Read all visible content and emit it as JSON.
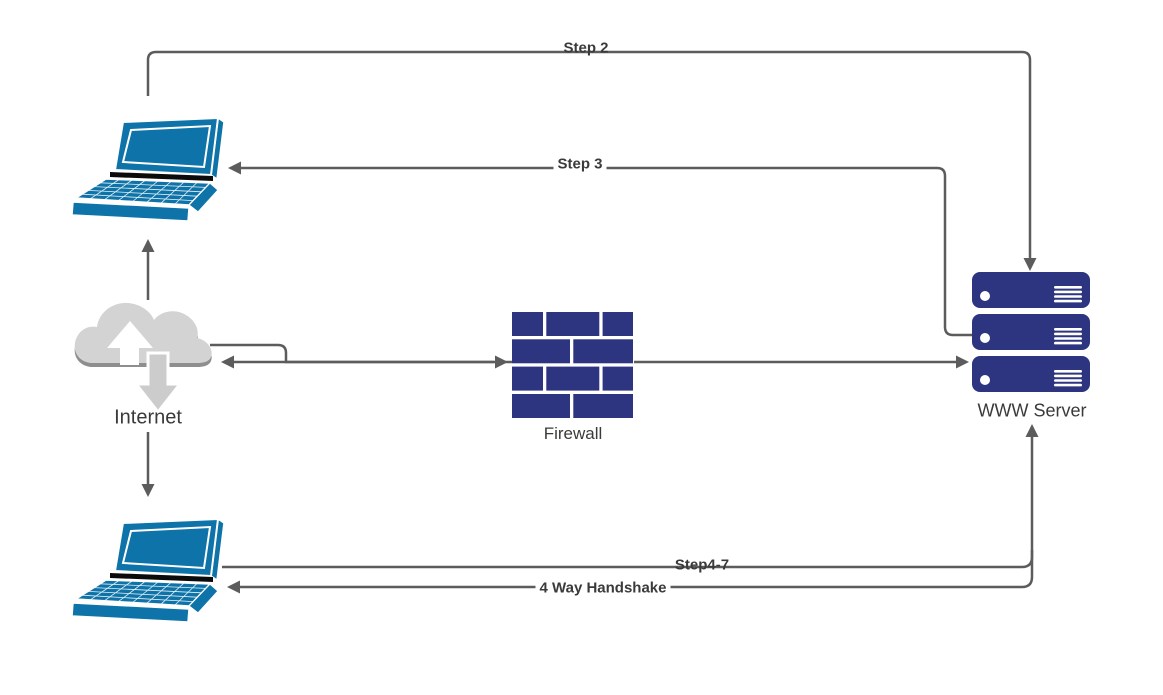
{
  "canvas": {
    "width": 1163,
    "height": 695,
    "background": "#ffffff"
  },
  "colors": {
    "device_blue": "#0d73a8",
    "navy": "#2d3480",
    "cloud_gray": "#d3d3d3",
    "cloud_shadow_gray": "#8e8e8e",
    "connector_gray": "#5c5c5c",
    "label_color": "#3a3a3a"
  },
  "nodes": {
    "internet": {
      "label": "Internet",
      "icon": "cloud-with-arrows"
    },
    "firewall": {
      "label": "Firewall",
      "icon": "brick-wall"
    },
    "server": {
      "label": "WWW Server",
      "icon": "server-stack"
    },
    "client_top": {
      "icon": "laptop"
    },
    "client_bottom": {
      "icon": "laptop"
    }
  },
  "connectors": {
    "step2": {
      "label": "Step 2",
      "from": "client-top",
      "to": "server"
    },
    "step3": {
      "label": "Step 3",
      "from": "server",
      "to": "client-top"
    },
    "step4_7": {
      "label": "Step4-7",
      "from": "client-bottom",
      "to": "server"
    },
    "handshake": {
      "label": "4 Way Handshake",
      "from": "server",
      "to": "client-bottom"
    },
    "internet_to_firewall": {
      "from": "internet",
      "to": "firewall"
    },
    "firewall_to_internet": {
      "from": "firewall",
      "to": "internet"
    },
    "firewall_to_server": {
      "from": "firewall",
      "to": "server"
    },
    "internet_to_client_top": {
      "from": "internet",
      "to": "client-top"
    },
    "internet_to_client_bottom": {
      "from": "internet",
      "to": "client-bottom"
    }
  }
}
